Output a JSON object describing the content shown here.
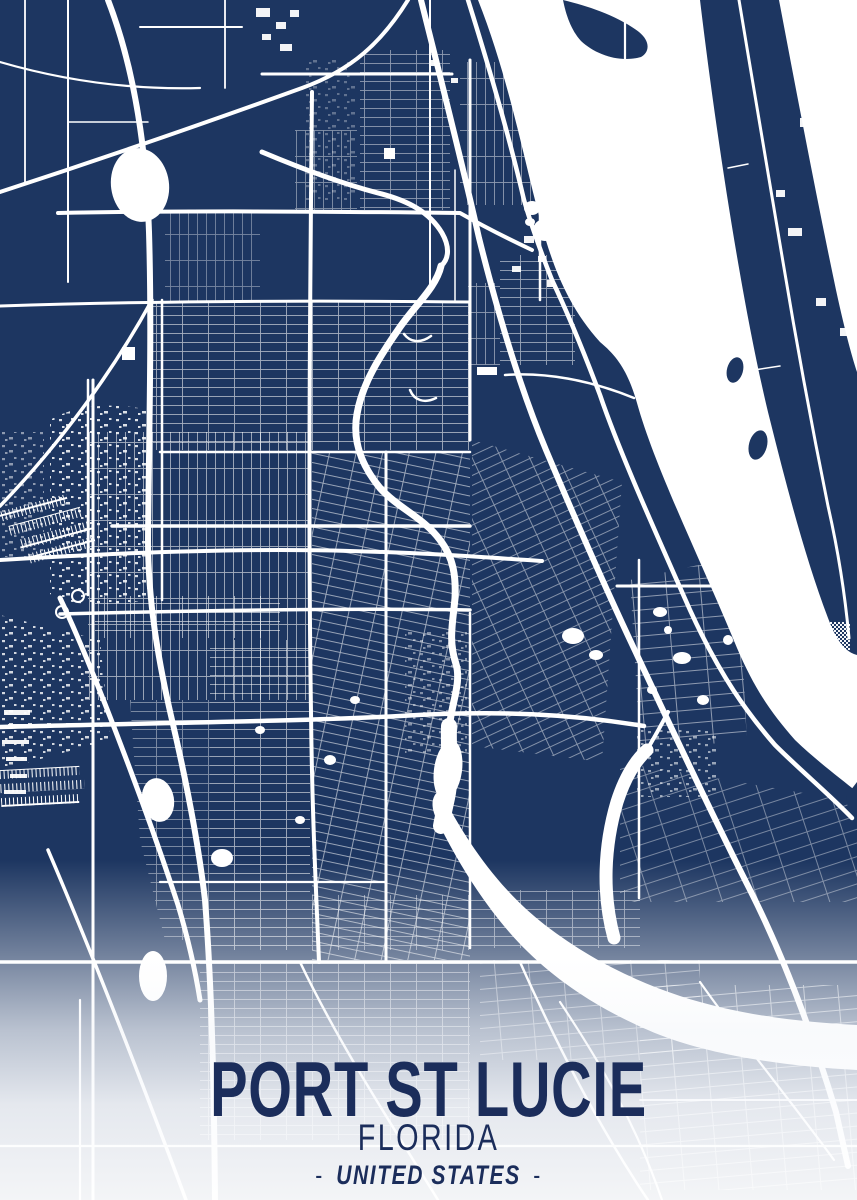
{
  "poster": {
    "title": "PORT ST LUCIE",
    "region": "FLORIDA",
    "country": "UNITED STATES",
    "separator": "-",
    "colors": {
      "land": "#1d3661",
      "water": "#ffffff",
      "road": "#ffffff",
      "title_text": "#1b2d5b"
    }
  }
}
